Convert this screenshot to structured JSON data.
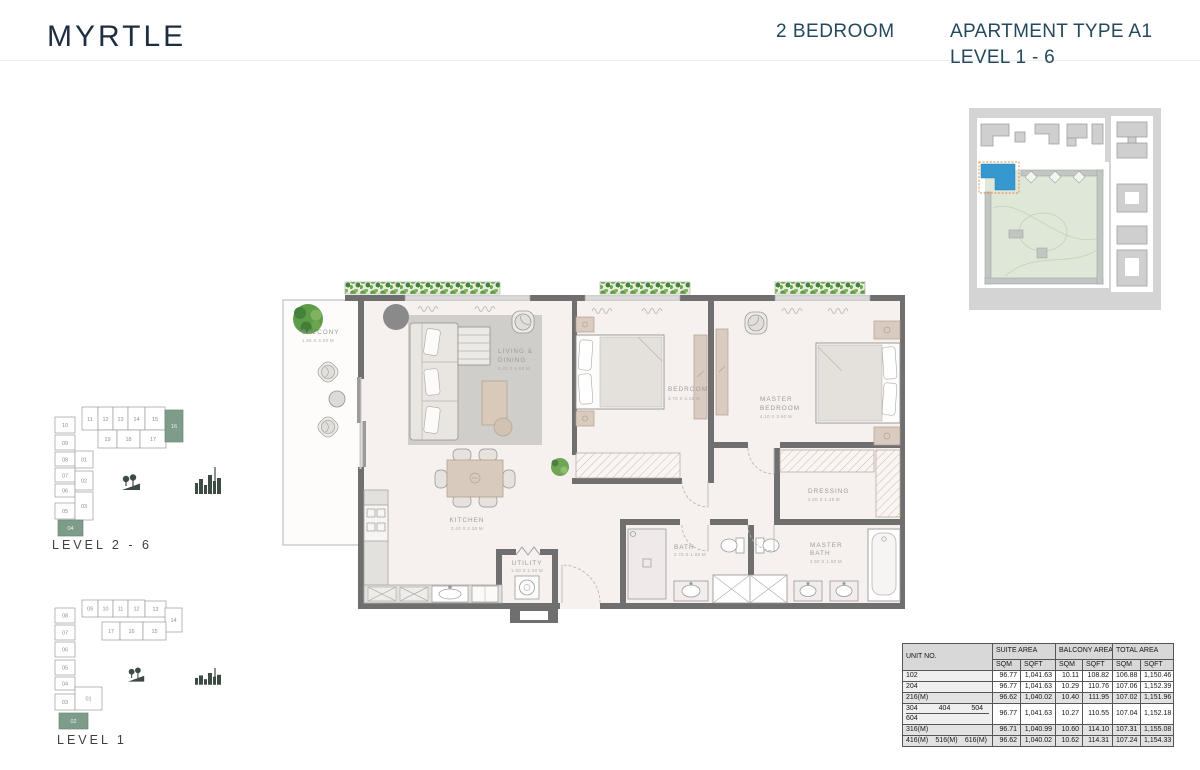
{
  "header": {
    "project_name": "MYRTLE",
    "bedroom_type": "2 BEDROOM",
    "apartment_type": "APARTMENT TYPE A1",
    "level_range": "LEVEL 1 - 6"
  },
  "floor_plan": {
    "rooms": [
      {
        "line1": "BALCONY",
        "line2": "",
        "dims": "1.55 X 4.00 M"
      },
      {
        "line1": "LIVING &",
        "line2": "DINING",
        "dims": "5.20 X 4.55 M"
      },
      {
        "line1": "BEDROOM",
        "line2": "",
        "dims": "3.70 X 4.15 M"
      },
      {
        "line1": "MASTER",
        "line2": "BEDROOM",
        "dims": "4.10 X 3.60 M"
      },
      {
        "line1": "DRESSING",
        "line2": "",
        "dims": "2.60 X 1.45 M"
      },
      {
        "line1": "KITCHEN",
        "line2": "",
        "dims": "3.40 X 2.20 M"
      },
      {
        "line1": "UTILITY",
        "line2": "",
        "dims": "1.30 X 1.00 M"
      },
      {
        "line1": "BATH",
        "line2": "",
        "dims": "2.70 X 1.80 M"
      },
      {
        "line1": "MASTER",
        "line2": "BATH",
        "dims": "2.50 X 1.80 M"
      }
    ]
  },
  "key_plans": [
    {
      "label": "LEVEL 2 - 6",
      "units": {
        "left": [
          "10",
          "09",
          "08",
          "07",
          "06",
          "05"
        ],
        "left_highlight": "04",
        "inner": [
          "01",
          "02",
          "03"
        ],
        "top": [
          "11",
          "12",
          "13",
          "14",
          "15"
        ],
        "top_highlight": "16",
        "row2": [
          "19",
          "18",
          "17"
        ]
      }
    },
    {
      "label": "LEVEL 1",
      "units": {
        "left": [
          "08",
          "07",
          "06",
          "05",
          "04",
          "03"
        ],
        "inner": [
          "01"
        ],
        "top": [
          "09",
          "10",
          "11",
          "12",
          "13",
          "14"
        ],
        "row2": [
          "17",
          "16",
          "15"
        ],
        "bottom_highlight": "02"
      }
    }
  ],
  "area_table": {
    "headers": {
      "unit": "UNIT NO.",
      "suite": "SUITE AREA",
      "balcony": "BALCONY AREA",
      "total": "TOTAL AREA",
      "sqm": "SQM",
      "sqft": "SQFT"
    },
    "rows": [
      {
        "units": [
          "102"
        ],
        "values": [
          "96.77",
          "1,041.63",
          "10.11",
          "108.82",
          "106.88",
          "1,150.46"
        ]
      },
      {
        "units": [
          "204"
        ],
        "values": [
          "96.77",
          "1,041.63",
          "10.29",
          "110.76",
          "107.06",
          "1,152.39"
        ]
      },
      {
        "units": [
          "216(M)"
        ],
        "values": [
          "96.62",
          "1,040.02",
          "10.40",
          "111.95",
          "107.02",
          "1,151.96"
        ]
      },
      {
        "units": [
          "304",
          "404",
          "504"
        ],
        "units_line2": [
          "604"
        ],
        "values": [
          "96.77",
          "1,041.63",
          "10.27",
          "110.55",
          "107.04",
          "1,152.18"
        ]
      },
      {
        "units": [
          "316(M)"
        ],
        "values": [
          "96.71",
          "1,040.99",
          "10.60",
          "114.10",
          "107.31",
          "1,155.08"
        ]
      },
      {
        "units": [
          "416(M)",
          "516(M)",
          "616(M)"
        ],
        "values": [
          "96.62",
          "1,040.02",
          "10.62",
          "114.31",
          "107.24",
          "1,154.33"
        ]
      }
    ]
  },
  "colors": {
    "brand_text": "#1e2e3e",
    "header_text": "#24495c",
    "keyplan_highlight": "#7d9c89",
    "siteplan_building_highlight": "#3598cf",
    "siteplan_highlight_outline": "#e0873f",
    "plan_wall": "#6f6f6f",
    "plan_floor": "#f6f0ef",
    "plan_label": "#9c9c9c",
    "planter_green": "#5f9c49"
  }
}
